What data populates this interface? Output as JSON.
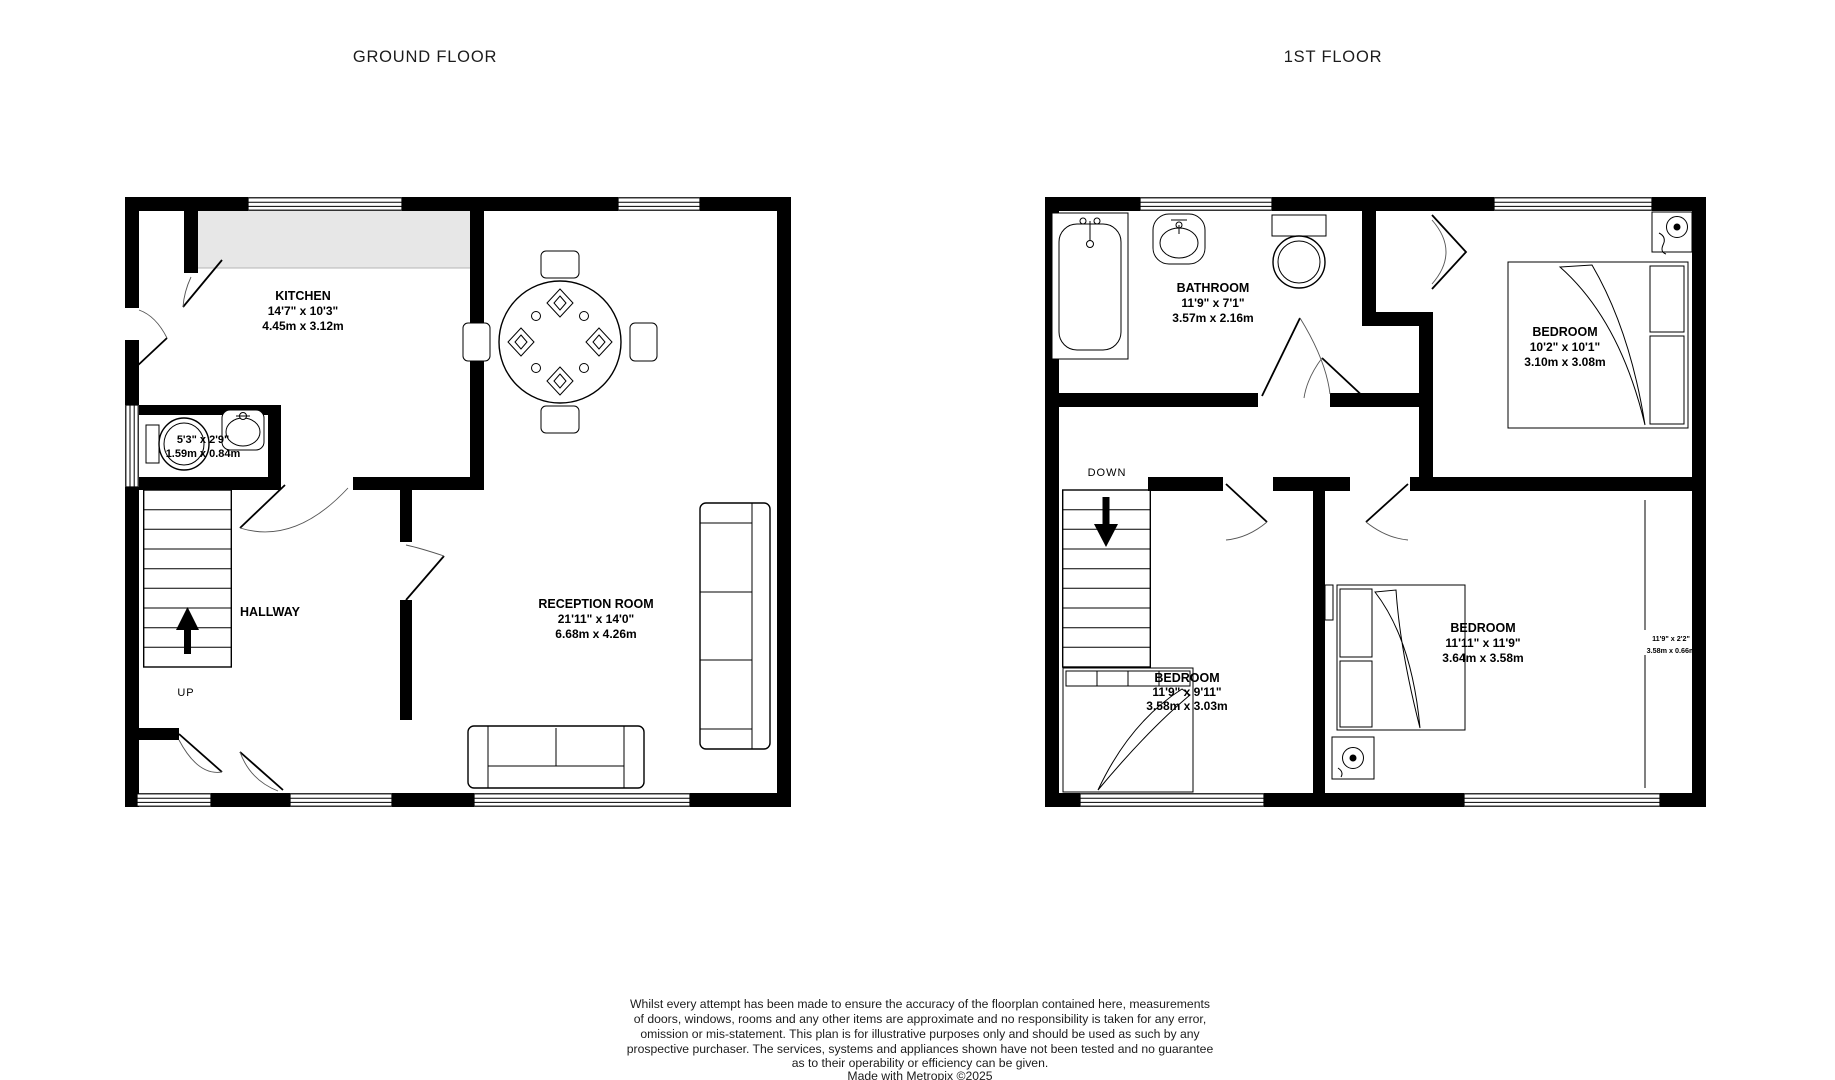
{
  "titles": {
    "ground_floor": "GROUND FLOOR",
    "first_floor": "1ST FLOOR"
  },
  "ground_floor": {
    "kitchen": {
      "name": "KITCHEN",
      "imperial": "14'7\"  x 10'3\"",
      "metric": "4.45m  x 3.12m"
    },
    "wc": {
      "imperial": "5'3\"  x 2'9\"",
      "metric": "1.59m  x 0.84m"
    },
    "hallway": {
      "name": "HALLWAY"
    },
    "stairs": {
      "label": "UP"
    },
    "reception": {
      "name": "RECEPTION ROOM",
      "imperial": "21'11\"  x 14'0\"",
      "metric": "6.68m  x 4.26m"
    }
  },
  "first_floor": {
    "bathroom": {
      "name": "BATHROOM",
      "imperial": "11'9\"  x 7'1\"",
      "metric": "3.57m  x 2.16m"
    },
    "bedroom_top": {
      "name": "BEDROOM",
      "imperial": "10'2\"  x 10'1\"",
      "metric": "3.10m  x 3.08m"
    },
    "stairs": {
      "label": "DOWN"
    },
    "bedroom_left": {
      "name": "BEDROOM",
      "imperial": "11'9\"  x 9'11\"",
      "metric": "3.58m  x 3.03m"
    },
    "bedroom_main": {
      "name": "BEDROOM",
      "imperial": "11'11\"  x 11'9\"",
      "metric": "3.64m  x 3.58m"
    },
    "bay": {
      "imperial": "11'9\"  x 2'2\"",
      "metric": "3.58m  x 0.66m"
    }
  },
  "disclaimer": {
    "lines": [
      "Whilst every attempt has been made to ensure the accuracy of the floorplan contained here, measurements",
      "of doors, windows, rooms and any other items are approximate and no responsibility is taken for any error,",
      "omission or mis-statement. This plan is for illustrative purposes only and should be used as such by any",
      "prospective purchaser. The services, systems and appliances shown have not been tested and no guarantee",
      "as to their operability or efficiency can be given.",
      "Made with Metropix ©2025"
    ]
  },
  "colors": {
    "wall": "#000000",
    "counter": "#e7e7e7",
    "background": "#ffffff"
  }
}
